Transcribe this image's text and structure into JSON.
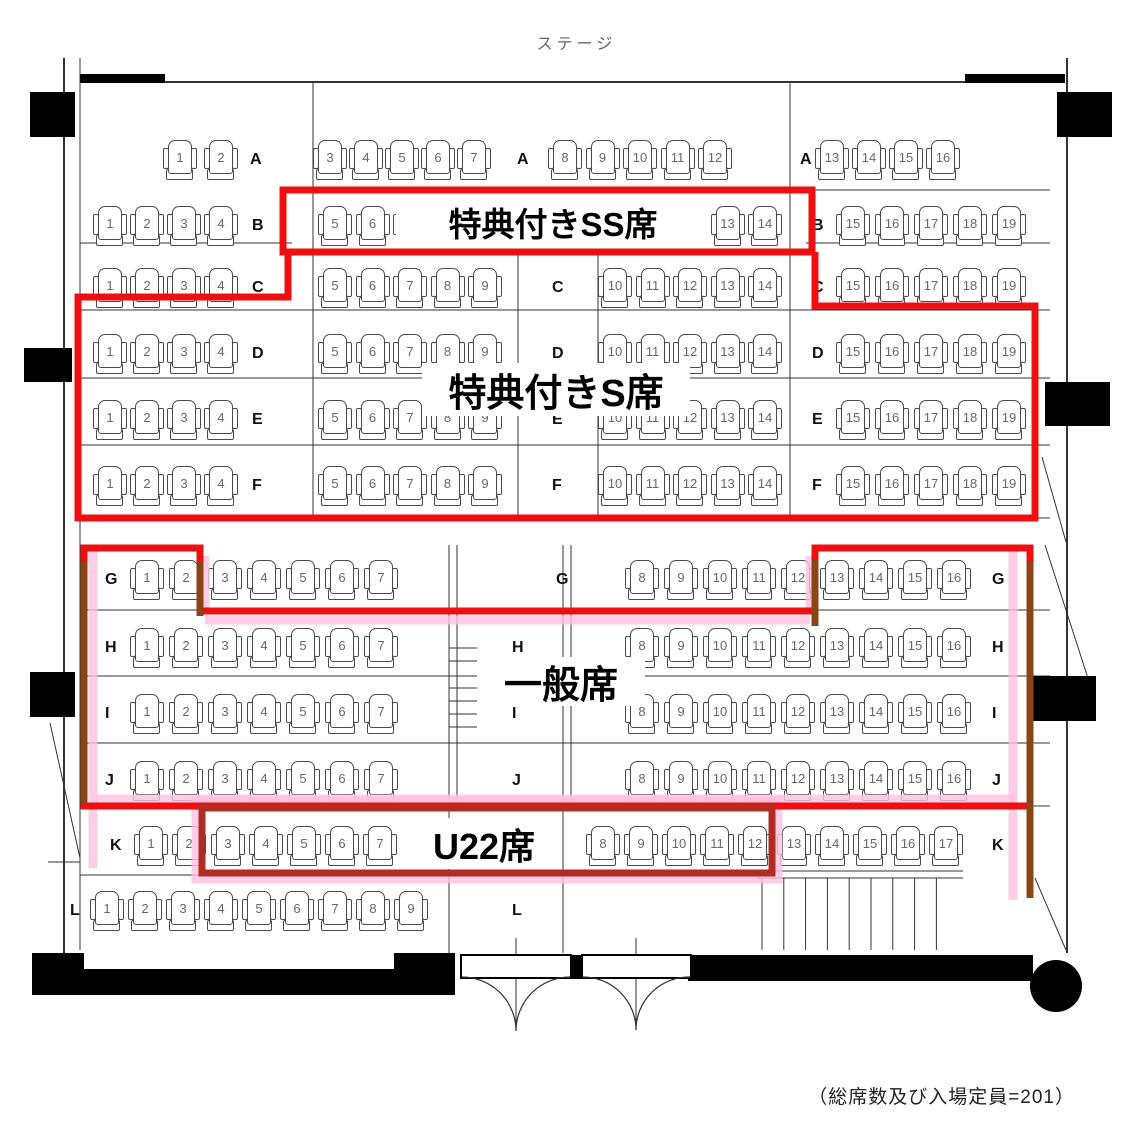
{
  "stage_label": "ステージ",
  "capacity_note": "（総席数及び入場定員=201）",
  "zones": {
    "ss": {
      "label": "特典付きSS席",
      "outline_color": "#ee1010"
    },
    "s": {
      "label": "特典付きS席",
      "outline_color": "#ee1010"
    },
    "general": {
      "label": "一般席",
      "outline_color": "#ee1010"
    },
    "u22": {
      "label": "U22席",
      "outline_color": "#b02d24"
    }
  },
  "rows": [
    {
      "letter": "A",
      "y": 140,
      "letter_positions": [
        250,
        517,
        800
      ],
      "groups": [
        {
          "x": 165,
          "pitch": 41,
          "seats": [
            "1",
            "2"
          ]
        },
        {
          "x": 315,
          "pitch": 36,
          "seats": [
            "3",
            "4",
            "5",
            "6",
            "7"
          ]
        },
        {
          "x": 550,
          "pitch": 37.5,
          "seats": [
            "8",
            "9",
            "10",
            "11",
            "12"
          ]
        },
        {
          "x": 817,
          "pitch": 37,
          "seats": [
            "13",
            "14",
            "15",
            "16"
          ]
        }
      ]
    },
    {
      "letter": "B",
      "y": 206,
      "letter_positions": [
        252,
        812
      ],
      "groups": [
        {
          "x": 95,
          "pitch": 37,
          "seats": [
            "1",
            "2",
            "3",
            "4"
          ]
        },
        {
          "x": 320,
          "pitch": 37.5,
          "seats": [
            "5",
            "6",
            "7",
            "8",
            "9"
          ]
        },
        {
          "x": 600,
          "pitch": 37.5,
          "seats": [
            "10",
            "11",
            "12",
            "13",
            "14"
          ]
        },
        {
          "x": 838,
          "pitch": 39,
          "seats": [
            "15",
            "16",
            "17",
            "18",
            "19"
          ]
        }
      ]
    },
    {
      "letter": "C",
      "y": 268,
      "letter_positions": [
        252,
        552,
        812
      ],
      "groups": [
        {
          "x": 95,
          "pitch": 37,
          "seats": [
            "1",
            "2",
            "3",
            "4"
          ]
        },
        {
          "x": 320,
          "pitch": 37.5,
          "seats": [
            "5",
            "6",
            "7",
            "8",
            "9"
          ]
        },
        {
          "x": 600,
          "pitch": 37.5,
          "seats": [
            "10",
            "11",
            "12",
            "13",
            "14"
          ]
        },
        {
          "x": 838,
          "pitch": 39,
          "seats": [
            "15",
            "16",
            "17",
            "18",
            "19"
          ]
        }
      ]
    },
    {
      "letter": "D",
      "y": 334,
      "letter_positions": [
        252,
        552,
        812
      ],
      "groups": [
        {
          "x": 95,
          "pitch": 37,
          "seats": [
            "1",
            "2",
            "3",
            "4"
          ]
        },
        {
          "x": 320,
          "pitch": 37.5,
          "seats": [
            "5",
            "6",
            "7",
            "8",
            "9"
          ]
        },
        {
          "x": 600,
          "pitch": 37.5,
          "seats": [
            "10",
            "11",
            "12",
            "13",
            "14"
          ]
        },
        {
          "x": 838,
          "pitch": 39,
          "seats": [
            "15",
            "16",
            "17",
            "18",
            "19"
          ]
        }
      ]
    },
    {
      "letter": "E",
      "y": 400,
      "letter_positions": [
        252,
        552,
        812
      ],
      "groups": [
        {
          "x": 95,
          "pitch": 37,
          "seats": [
            "1",
            "2",
            "3",
            "4"
          ]
        },
        {
          "x": 320,
          "pitch": 37.5,
          "seats": [
            "5",
            "6",
            "7",
            "8",
            "9"
          ]
        },
        {
          "x": 600,
          "pitch": 37.5,
          "seats": [
            "10",
            "11",
            "12",
            "13",
            "14"
          ]
        },
        {
          "x": 838,
          "pitch": 39,
          "seats": [
            "15",
            "16",
            "17",
            "18",
            "19"
          ]
        }
      ]
    },
    {
      "letter": "F",
      "y": 466,
      "letter_positions": [
        252,
        552,
        812
      ],
      "groups": [
        {
          "x": 95,
          "pitch": 37,
          "seats": [
            "1",
            "2",
            "3",
            "4"
          ]
        },
        {
          "x": 320,
          "pitch": 37.5,
          "seats": [
            "5",
            "6",
            "7",
            "8",
            "9"
          ]
        },
        {
          "x": 600,
          "pitch": 37.5,
          "seats": [
            "10",
            "11",
            "12",
            "13",
            "14"
          ]
        },
        {
          "x": 838,
          "pitch": 39,
          "seats": [
            "15",
            "16",
            "17",
            "18",
            "19"
          ]
        }
      ]
    },
    {
      "letter": "G",
      "y": 560,
      "letter_positions": [
        105,
        556,
        992
      ],
      "groups": [
        {
          "x": 132,
          "pitch": 39,
          "seats": [
            "1",
            "2",
            "3",
            "4",
            "5",
            "6",
            "7"
          ]
        },
        {
          "x": 627,
          "pitch": 39,
          "seats": [
            "8",
            "9",
            "10",
            "11",
            "12",
            "13",
            "14",
            "15",
            "16"
          ]
        }
      ]
    },
    {
      "letter": "H",
      "y": 628,
      "letter_positions": [
        105,
        512,
        992
      ],
      "groups": [
        {
          "x": 132,
          "pitch": 39,
          "seats": [
            "1",
            "2",
            "3",
            "4",
            "5",
            "6",
            "7"
          ]
        },
        {
          "x": 627,
          "pitch": 39,
          "seats": [
            "8",
            "9",
            "10",
            "11",
            "12",
            "13",
            "14",
            "15",
            "16"
          ]
        }
      ]
    },
    {
      "letter": "I",
      "y": 694,
      "letter_positions": [
        105,
        512,
        992
      ],
      "groups": [
        {
          "x": 132,
          "pitch": 39,
          "seats": [
            "1",
            "2",
            "3",
            "4",
            "5",
            "6",
            "7"
          ]
        },
        {
          "x": 627,
          "pitch": 39,
          "seats": [
            "8",
            "9",
            "10",
            "11",
            "12",
            "13",
            "14",
            "15",
            "16"
          ]
        }
      ]
    },
    {
      "letter": "J",
      "y": 761,
      "letter_positions": [
        105,
        512,
        992
      ],
      "groups": [
        {
          "x": 132,
          "pitch": 39,
          "seats": [
            "1",
            "2",
            "3",
            "4",
            "5",
            "6",
            "7"
          ]
        },
        {
          "x": 627,
          "pitch": 39,
          "seats": [
            "8",
            "9",
            "10",
            "11",
            "12",
            "13",
            "14",
            "15",
            "16"
          ]
        }
      ]
    },
    {
      "letter": "K",
      "y": 826,
      "letter_positions": [
        110,
        992
      ],
      "groups": [
        {
          "x": 136,
          "pitch": 38,
          "seats": [
            "1",
            "2"
          ]
        },
        {
          "x": 213,
          "pitch": 38,
          "seats": [
            "3",
            "4",
            "5",
            "6",
            "7"
          ]
        },
        {
          "x": 588,
          "pitch": 38,
          "seats": [
            "8",
            "9",
            "10",
            "11",
            "12"
          ]
        },
        {
          "x": 779,
          "pitch": 38,
          "seats": [
            "13",
            "14",
            "15",
            "16",
            "17"
          ]
        }
      ]
    },
    {
      "letter": "L",
      "y": 891,
      "letter_positions": [
        70,
        512
      ],
      "groups": [
        {
          "x": 92,
          "pitch": 38,
          "seats": [
            "1",
            "2",
            "3",
            "4",
            "5",
            "6",
            "7",
            "8",
            "9"
          ]
        }
      ]
    }
  ]
}
